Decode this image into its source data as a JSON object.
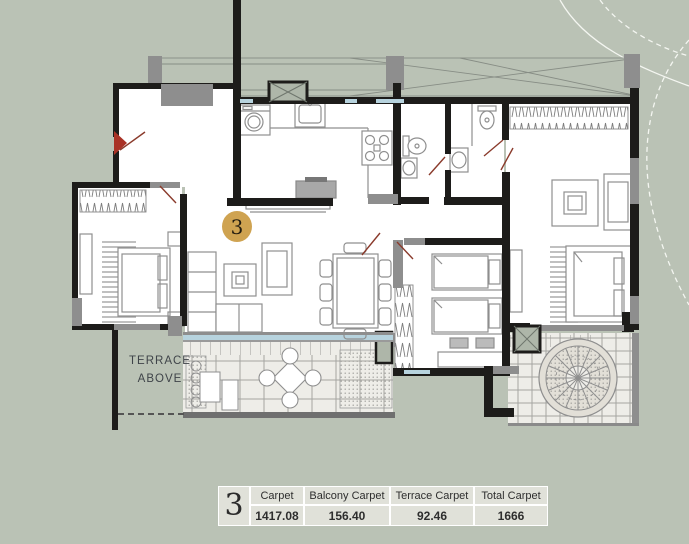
{
  "plan": {
    "marker_label": "3",
    "terrace_note": {
      "line1": "TERRACE",
      "line2": "ABOVE"
    }
  },
  "area_table": {
    "unit": "3",
    "columns": [
      "Carpet",
      "Balcony Carpet",
      "Terrace Carpet",
      "Total Carpet"
    ],
    "values": [
      "1417.08",
      "156.40",
      "92.46",
      "1666"
    ]
  },
  "colors": {
    "background": "#bac2b5",
    "wall_black": "#1d1c1a",
    "wall_gray": "#8e8e8e",
    "furniture_line": "#8f8f8f",
    "door_red": "#8a3a2b",
    "window_blue": "#b7d3de",
    "marker_gold": "#cfa351",
    "table_cell": "#e0e1d9",
    "paving": "#eeede8"
  }
}
